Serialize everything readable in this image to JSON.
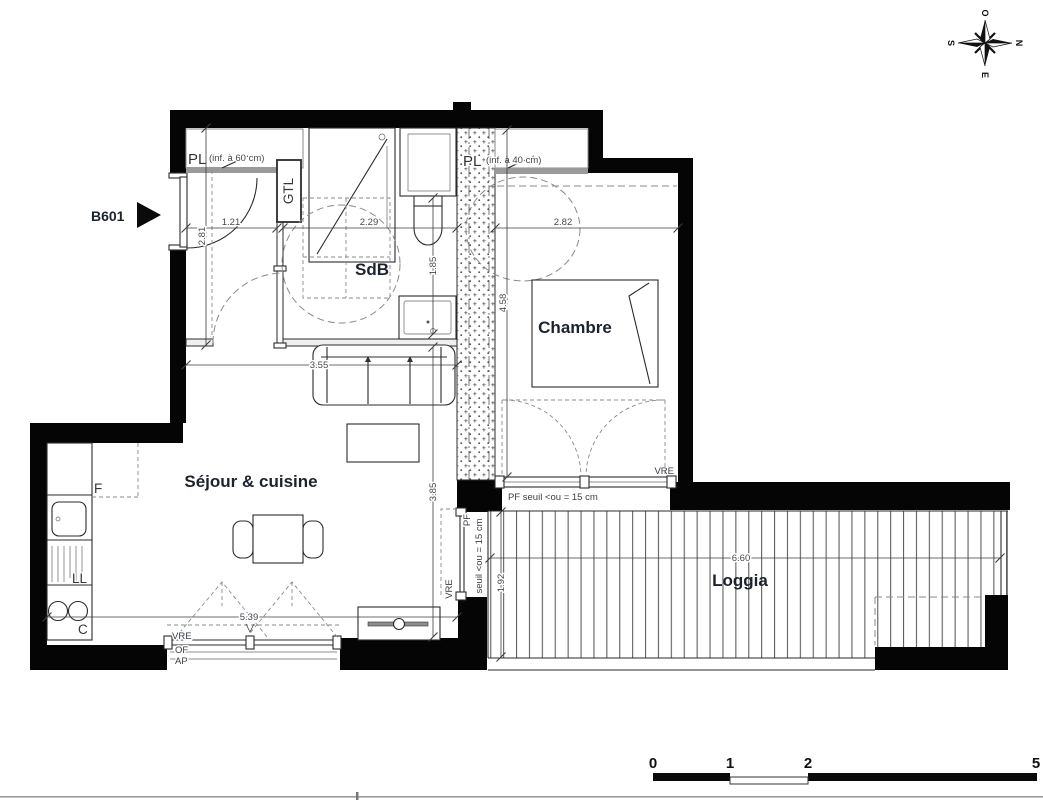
{
  "plan": {
    "unit": "B601",
    "rooms": {
      "bathroom": "SdB",
      "bedroom": "Chambre",
      "living": "Séjour & cuisine",
      "loggia": "Loggia"
    },
    "closets": {
      "hall_label": "PL",
      "hall_note": "(inf. à 60 cm)",
      "bedroom_label": "PL",
      "bedroom_note": "(inf. à 40 cm)",
      "gtl": "GTL"
    },
    "kitchen": {
      "fridge": "F",
      "washer": "LL",
      "cooktop": "C"
    },
    "openings": {
      "vre_living": "VRE",
      "of": "OF",
      "ap": "AP",
      "vre_bedroom": "VRE",
      "vre_loggia": "VRE",
      "pf_bedroom": "PF seuil <ou = 15 cm",
      "pf_loggia_line1": "PF",
      "pf_loggia_line2": "seuil <ou = 15 cm"
    },
    "dimensions": {
      "hall_width": "1.21",
      "hall_depth": "2.81",
      "bathroom_width": "2.29",
      "bathroom_depth": "1.85",
      "bedroom_width": "2.82",
      "bedroom_depth": "4.58",
      "living_width_top": "3.55",
      "living_depth": "3.85",
      "living_width": "5.39",
      "loggia_depth": "1.92",
      "loggia_width": "6.60"
    },
    "compass": {
      "north": "N",
      "south": "S",
      "east": "E",
      "west": "O"
    },
    "scale": {
      "t0": "0",
      "t1": "1",
      "t2": "2",
      "t5": "5"
    }
  }
}
